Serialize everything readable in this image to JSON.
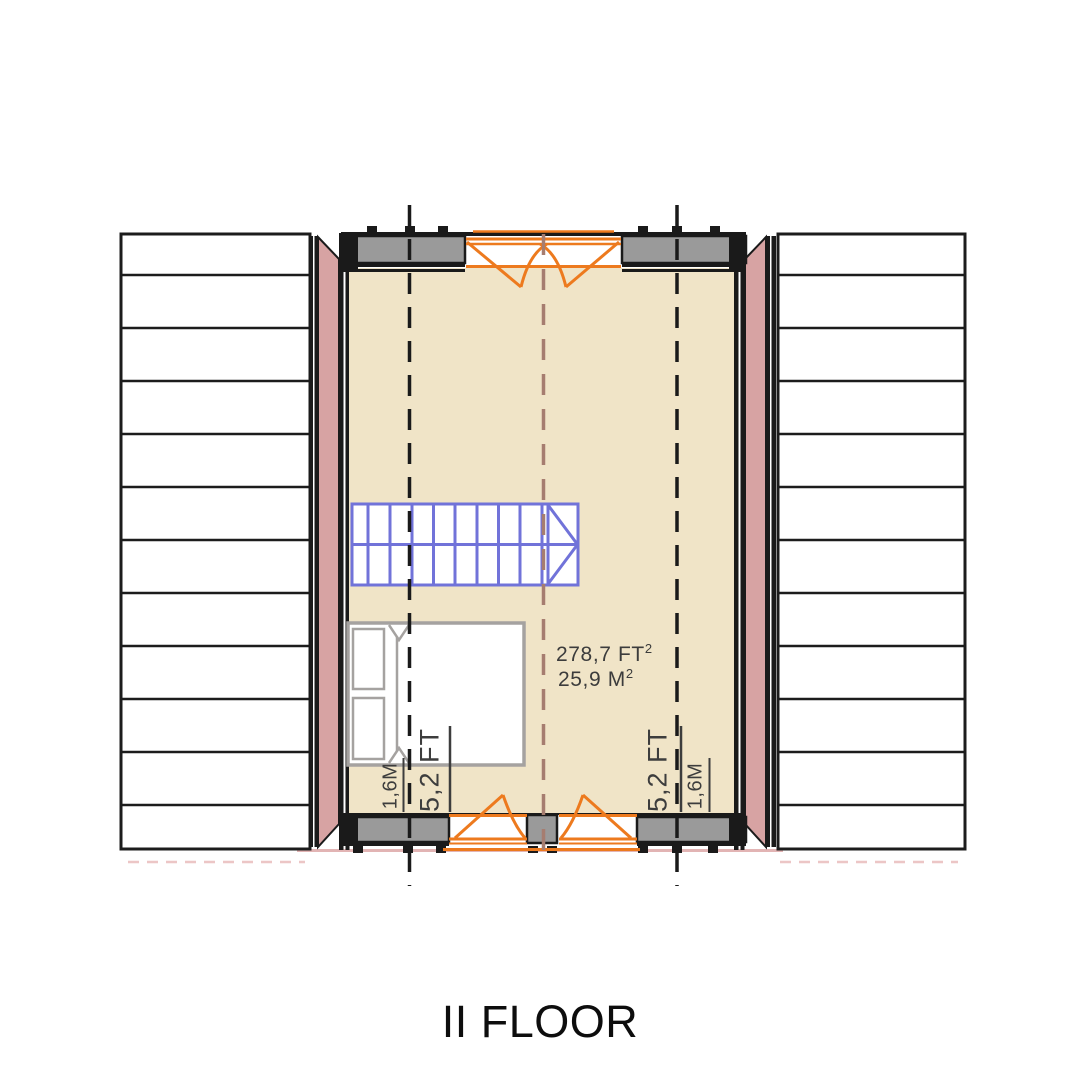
{
  "meta": {
    "title": "II FLOOR",
    "drawing_type": "architectural floor plan, second (attic) floor"
  },
  "plan": {
    "room": {
      "area_ft": {
        "text": "278,7 FT",
        "sup": "2"
      },
      "area_m": {
        "text": "25,9 M",
        "sup": "2"
      }
    },
    "dimensions": {
      "left_inner": "1,6M",
      "left_outer": "5,2 FT",
      "right_outer": "5,2 FT",
      "right_inner": "1,6M"
    },
    "features": {
      "stairs": "staircase with direction arrow",
      "bed": "double bed with two pillows",
      "windows": "one top casement window, two bottom casement windows",
      "roof": "sloped roof planes with batten lines on both sides"
    },
    "colors": {
      "floor": "#f0e4c7",
      "side_wall_pink": "#d7a3a3",
      "window_sill_gray": "#9a9a9a",
      "window_symbol_orange": "#ed7a1e",
      "stairs_blue": "#7173d9",
      "bed_outline_gray": "#a5a2a0",
      "ridge_centerline": "#a67d70",
      "clearance_line_black": "#1a1a1a",
      "eave_line_pink": "#e2b4b4",
      "roof_line_black": "#1c1c1c"
    }
  }
}
